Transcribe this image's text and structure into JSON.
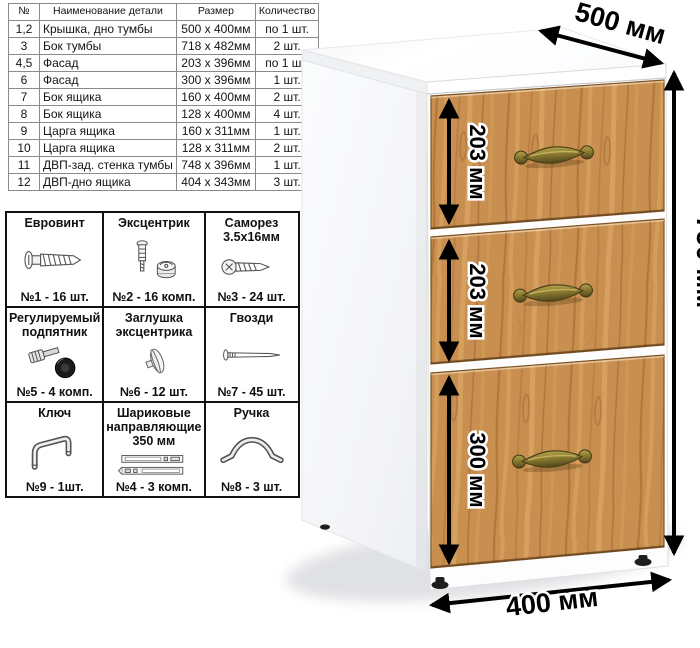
{
  "parts_table": {
    "headers": [
      "№",
      "Наименование детали",
      "Размер",
      "Количество"
    ],
    "rows": [
      [
        "1,2",
        "Крышка, дно тумбы",
        "500 x 400мм",
        "по 1 шт."
      ],
      [
        "3",
        "Бок тумбы",
        "718 x 482мм",
        "2 шт."
      ],
      [
        "4,5",
        "Фасад",
        "203 x 396мм",
        "по 1 шт."
      ],
      [
        "6",
        "Фасад",
        "300 x 396мм",
        "1 шт."
      ],
      [
        "7",
        "Бок ящика",
        "160 x 400мм",
        "2 шт."
      ],
      [
        "8",
        "Бок ящика",
        "128 x 400мм",
        "4 шт."
      ],
      [
        "9",
        "Царга ящика",
        "160 x 311мм",
        "1 шт."
      ],
      [
        "10",
        "Царга ящика",
        "128 x 311мм",
        "2 шт."
      ],
      [
        "11",
        "ДВП-зад. стенка тумбы",
        "748 x 396мм",
        "1 шт."
      ],
      [
        "12",
        "ДВП-дно ящика",
        "404 x 343мм",
        "3 шт."
      ]
    ]
  },
  "hardware": {
    "items": [
      {
        "title": "Евровинт",
        "count": "№1 - 16 шт.",
        "icon": "euro-screw-icon"
      },
      {
        "title": "Эксцентрик",
        "count": "№2 - 16 комп.",
        "icon": "cam-lock-icon"
      },
      {
        "title": "Саморез\n3.5х16мм",
        "count": "№3 - 24 шт.",
        "icon": "self-tapping-screw-icon"
      },
      {
        "title": "Регулируемый\nподпятник",
        "count": "№5 - 4 комп.",
        "icon": "adjustable-foot-icon"
      },
      {
        "title": "Заглушка\nэксцентрика",
        "count": "№6 - 12 шт.",
        "icon": "cam-cover-icon"
      },
      {
        "title": "Гвозди",
        "count": "№7 - 45 шт.",
        "icon": "nail-icon"
      },
      {
        "title": "Ключ",
        "count": "№9 - 1шт.",
        "icon": "hex-key-icon"
      },
      {
        "title": "Шариковые\nнаправляющие\n350 мм",
        "count": "№4 - 3 комп.",
        "icon": "ball-bearing-slides-icon"
      },
      {
        "title": "Ручка",
        "count": "№8 - 3 шт.",
        "icon": "handle-icon"
      }
    ]
  },
  "dimensions": {
    "depth": "500 мм",
    "height": "750 мм",
    "width": "400 мм",
    "drawer_top": "203 мм",
    "drawer_middle": "203 мм",
    "drawer_bottom": "300 мм"
  },
  "colors": {
    "wood_base": "#c98f50",
    "wood_dark": "#a86d32",
    "wood_light": "#e3b26d",
    "brass_handle": "#8a7a2f",
    "carcass_white": "#fdfdfe"
  }
}
